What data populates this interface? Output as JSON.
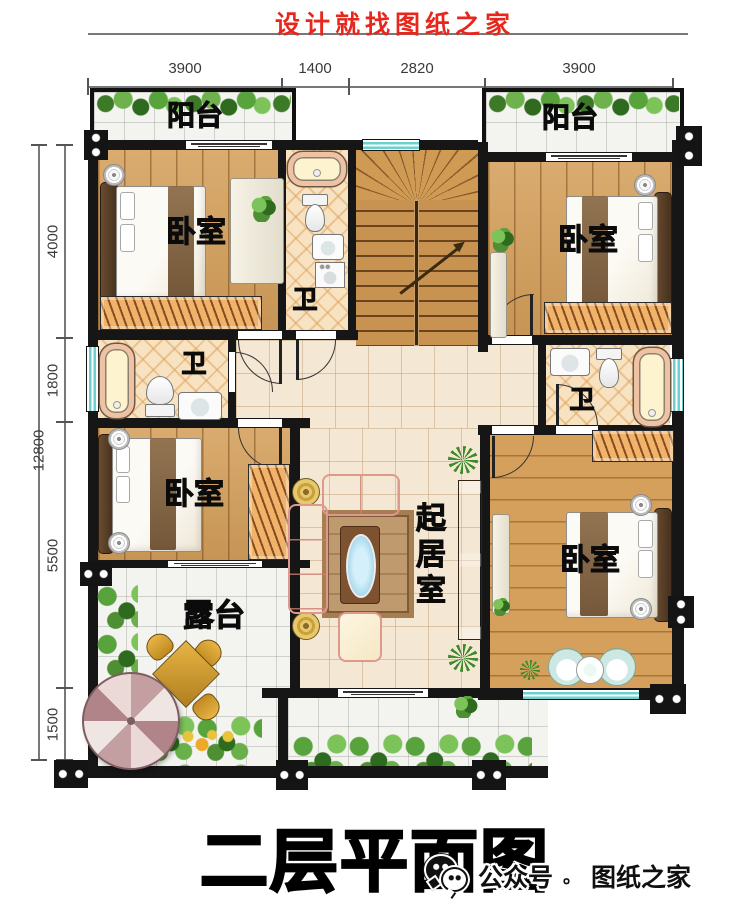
{
  "header": {
    "title": "设计就找图纸之家"
  },
  "dimensions": {
    "top": [
      "3900",
      "1400",
      "2820",
      "3900"
    ],
    "left_total": "12800",
    "left": [
      "4000",
      "1800",
      "5500",
      "1500"
    ]
  },
  "rooms": {
    "balcony_tl": "阳台",
    "balcony_tr": "阳台",
    "bedroom_tl": "卧室",
    "bedroom_tr": "卧室",
    "bedroom_bl": "卧室",
    "bedroom_br": "卧室",
    "bath_top": "卫",
    "bath_left": "卫",
    "bath_right": "卫",
    "living": "起居室",
    "terrace": "露台"
  },
  "footer": {
    "plan_title": "二层平面图",
    "account_label": "公众号",
    "separator": "。",
    "brand": "图纸之家"
  },
  "colors": {
    "accent_red": "#e8271c",
    "wall": "#161616",
    "window_teal": "#6ecfcf",
    "wood": "#d5a05b",
    "tile_beige": "#f4e7d4",
    "greenery": "#4e8f33"
  }
}
